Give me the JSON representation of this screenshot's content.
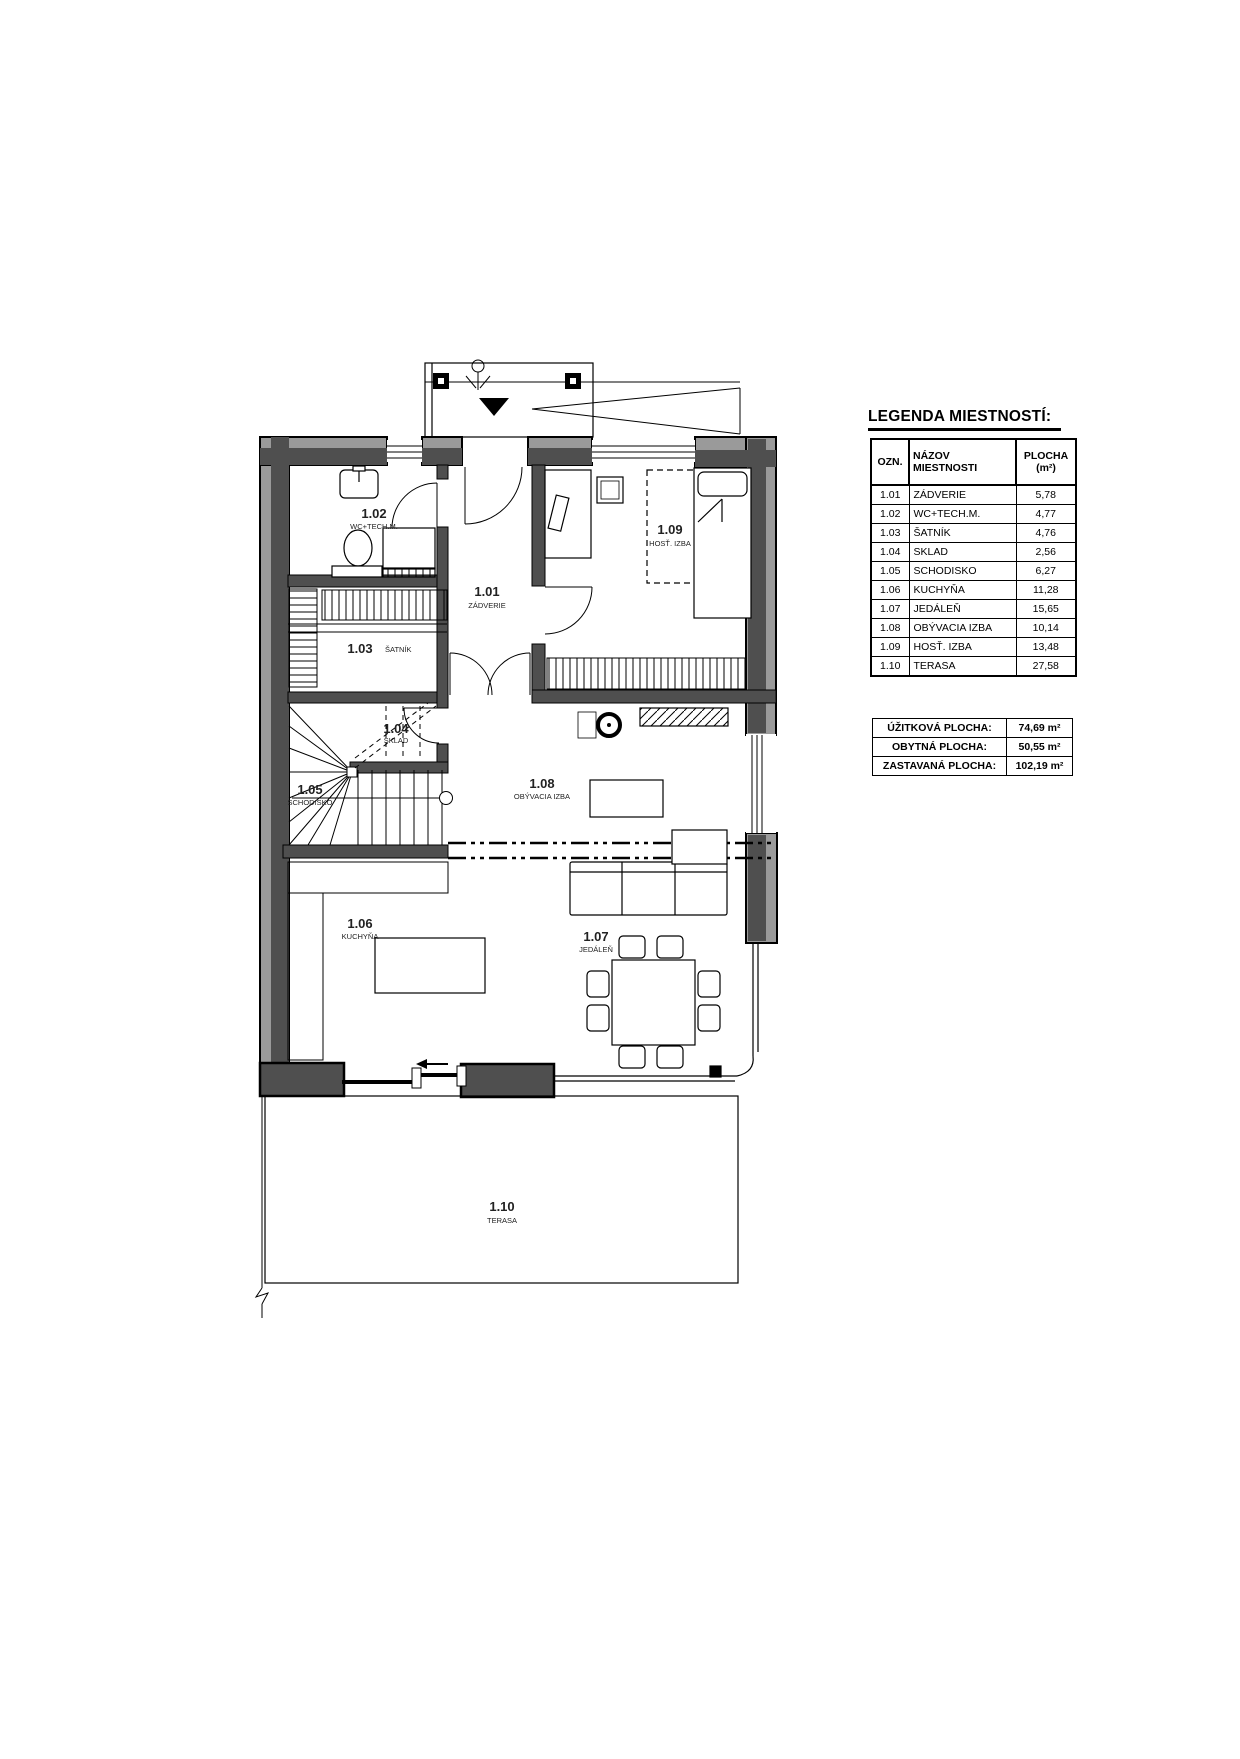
{
  "title": "LEGENDA MIESTNOSTÍ:",
  "legend": {
    "headers": {
      "ozn": "OZN.",
      "nazov": "NÁZOV MIESTNOSTI",
      "plocha_1": "PLOCHA",
      "plocha_2": "(m²)"
    },
    "rows": [
      {
        "ozn": "1.01",
        "nazov": "ZÁDVERIE",
        "plocha": "5,78"
      },
      {
        "ozn": "1.02",
        "nazov": "WC+TECH.M.",
        "plocha": "4,77"
      },
      {
        "ozn": "1.03",
        "nazov": "ŠATNÍK",
        "plocha": "4,76"
      },
      {
        "ozn": "1.04",
        "nazov": "SKLAD",
        "plocha": "2,56"
      },
      {
        "ozn": "1.05",
        "nazov": "SCHODISKO",
        "plocha": "6,27"
      },
      {
        "ozn": "1.06",
        "nazov": "KUCHYŇA",
        "plocha": "11,28"
      },
      {
        "ozn": "1.07",
        "nazov": "JEDÁLEŇ",
        "plocha": "15,65"
      },
      {
        "ozn": "1.08",
        "nazov": "OBÝVACIA IZBA",
        "plocha": "10,14"
      },
      {
        "ozn": "1.09",
        "nazov": "HOSŤ. IZBA",
        "plocha": "13,48"
      },
      {
        "ozn": "1.10",
        "nazov": "TERASA",
        "plocha": "27,58"
      }
    ]
  },
  "summary": {
    "rows": [
      {
        "label": "ÚŽITKOVÁ PLOCHA:",
        "value": "74,69 m²"
      },
      {
        "label": "OBYTNÁ PLOCHA:",
        "value": "50,55 m²"
      },
      {
        "label": "ZASTAVANÁ PLOCHA:",
        "value": "102,19 m²"
      }
    ]
  },
  "plan": {
    "rooms": [
      {
        "id": "1.01",
        "name": "ZÁDVERIE"
      },
      {
        "id": "1.02",
        "name": "WC+TECH.M."
      },
      {
        "id": "1.03",
        "name": "ŠATNÍK"
      },
      {
        "id": "1.04",
        "name": "SKLAD"
      },
      {
        "id": "1.05",
        "name": "SCHODISKO"
      },
      {
        "id": "1.06",
        "name": "KUCHYŇA"
      },
      {
        "id": "1.07",
        "name": "JEDÁLEŇ"
      },
      {
        "id": "1.08",
        "name": "OBÝVACIA IZBA"
      },
      {
        "id": "1.09",
        "name": "HOSŤ. IZBA"
      },
      {
        "id": "1.10",
        "name": "TERASA"
      }
    ],
    "colors": {
      "wall_dark": "#4f4f4f",
      "wall_light": "#9a9a9a",
      "line": "#000000"
    }
  }
}
